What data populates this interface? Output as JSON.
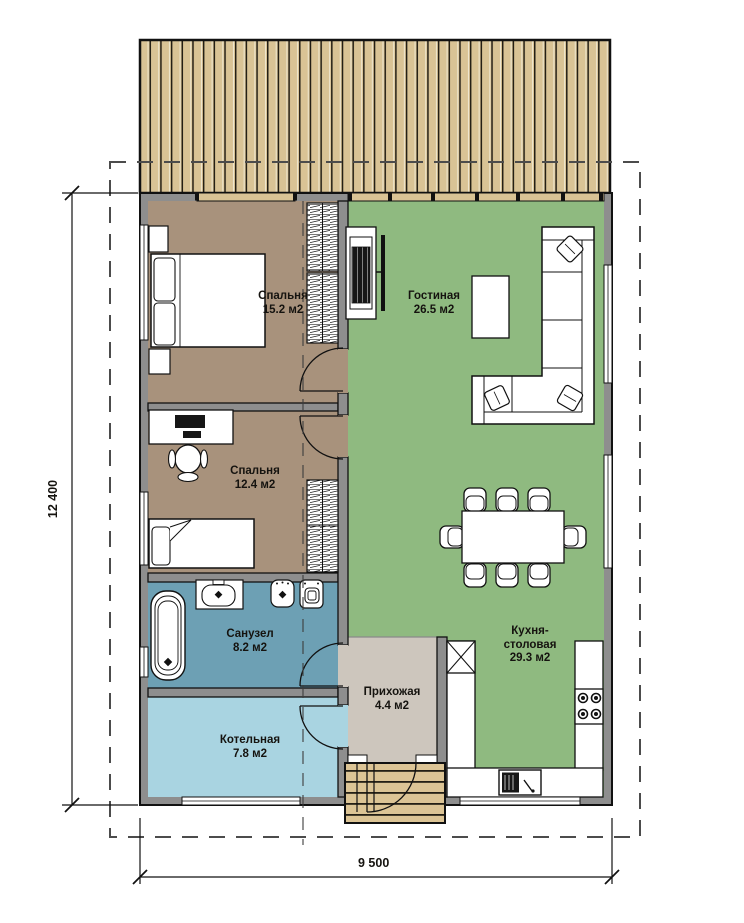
{
  "floor_plan": {
    "rooms": {
      "bedroom1": {
        "name": "Спальня",
        "area": "15.2 м2"
      },
      "bedroom2": {
        "name": "Спальня",
        "area": "12.4 м2"
      },
      "bathroom": {
        "name": "Санузел",
        "area": "8.2 м2"
      },
      "boiler": {
        "name": "Котельная",
        "area": "7.8 м2"
      },
      "living": {
        "name": "Гостиная",
        "area": "26.5 м2"
      },
      "kitchen": {
        "name_line1": "Кухня-",
        "name_line2": "столовая",
        "area": "29.3 м2"
      },
      "hallway": {
        "name": "Прихожая",
        "area": "4.4 м2"
      }
    },
    "dimensions": {
      "vertical": "12 400",
      "horizontal": "9 500"
    },
    "colors": {
      "bedroom": "#a8927c",
      "bathroom": "#6da0b4",
      "boiler": "#a9d4e1",
      "living": "#8fba80",
      "hallway": "#cdc6bd",
      "deck": "#d9c395",
      "wall": "#8e8e8e"
    }
  }
}
